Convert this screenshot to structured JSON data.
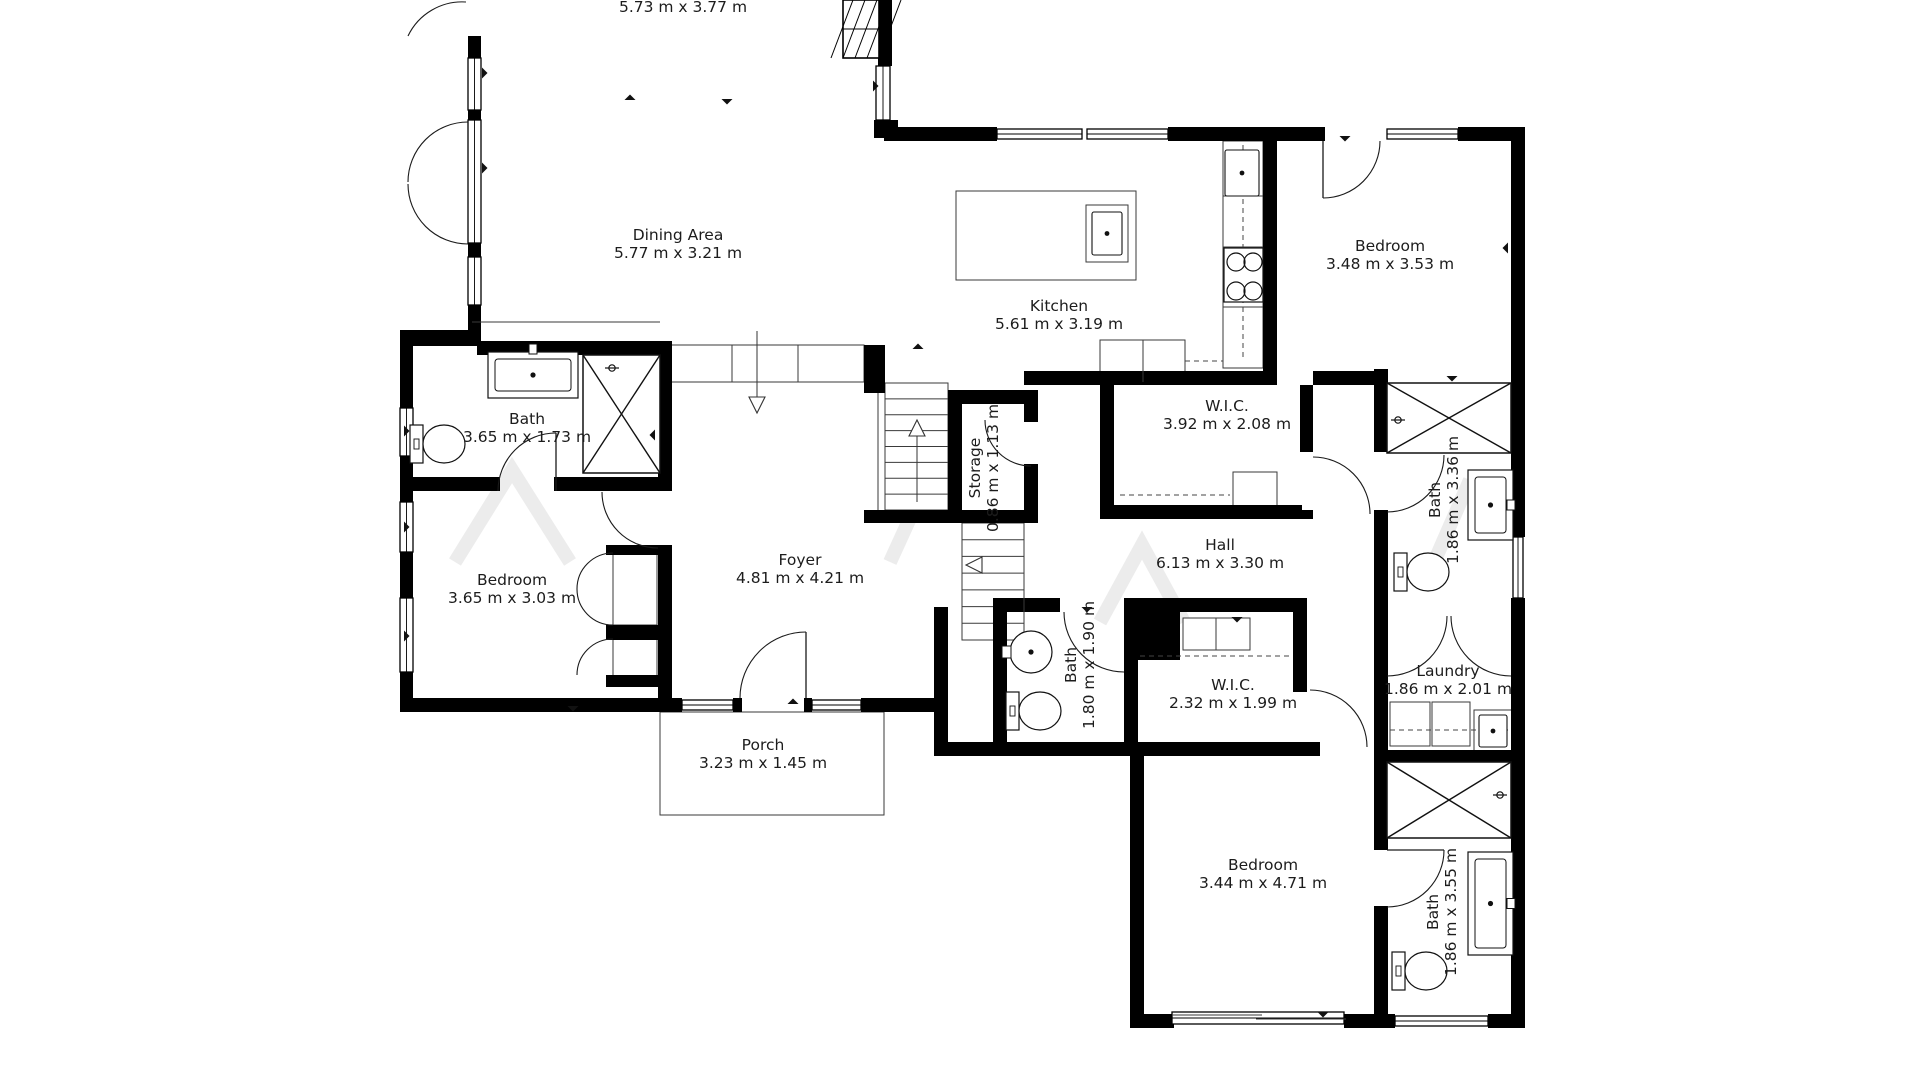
{
  "document": {
    "type": "floor-plan",
    "background": "#ffffff",
    "wall_color": "#000000",
    "line_color": "#222222",
    "label_color": "#1c1c1c"
  },
  "rooms": [
    {
      "id": "living",
      "lines": [
        "5.73 m x 3.77 m"
      ],
      "x": 683,
      "y": 12,
      "rot": 0
    },
    {
      "id": "dining",
      "lines": [
        "Dining Area",
        "5.77 m x 3.21 m"
      ],
      "x": 678,
      "y": 240,
      "rot": 0
    },
    {
      "id": "kitchen",
      "lines": [
        "Kitchen",
        "5.61 m x 3.19 m"
      ],
      "x": 1059,
      "y": 311,
      "rot": 0
    },
    {
      "id": "bedroom-tr",
      "lines": [
        "Bedroom",
        "3.48 m x 3.53 m"
      ],
      "x": 1390,
      "y": 251,
      "rot": 0
    },
    {
      "id": "bath-left",
      "lines": [
        "Bath",
        "3.65 m x 1.73 m"
      ],
      "x": 527,
      "y": 424,
      "rot": 0
    },
    {
      "id": "wic-top",
      "lines": [
        "W.I.C.",
        "3.92 m x 2.08 m"
      ],
      "x": 1227,
      "y": 411,
      "rot": 0
    },
    {
      "id": "hall",
      "lines": [
        "Hall",
        "6.13 m x 3.30 m"
      ],
      "x": 1220,
      "y": 550,
      "rot": 0
    },
    {
      "id": "bath-tr",
      "lines": [
        "Bath",
        "1.86 m x 3.36 m"
      ],
      "x": 1440,
      "y": 500,
      "rot": -90
    },
    {
      "id": "storage",
      "lines": [
        "Storage",
        "0.86 m x 1.13 m"
      ],
      "x": 980,
      "y": 468,
      "rot": -90
    },
    {
      "id": "bath-mid",
      "lines": [
        "Bath",
        "1.80 m x 1.90 m"
      ],
      "x": 1076,
      "y": 665,
      "rot": -90
    },
    {
      "id": "bedroom-l",
      "lines": [
        "Bedroom",
        "3.65 m x 3.03 m"
      ],
      "x": 512,
      "y": 585,
      "rot": 0
    },
    {
      "id": "foyer",
      "lines": [
        "Foyer",
        "4.81 m x 4.21 m"
      ],
      "x": 800,
      "y": 565,
      "rot": 0
    },
    {
      "id": "porch",
      "lines": [
        "Porch",
        "3.23 m x 1.45 m"
      ],
      "x": 763,
      "y": 750,
      "rot": 0
    },
    {
      "id": "wic-mid",
      "lines": [
        "W.I.C.",
        "2.32 m x 1.99 m"
      ],
      "x": 1233,
      "y": 690,
      "rot": 0
    },
    {
      "id": "laundry",
      "lines": [
        "Laundry",
        "1.86 m x 2.01 m"
      ],
      "x": 1448,
      "y": 676,
      "rot": 0
    },
    {
      "id": "bedroom-b",
      "lines": [
        "Bedroom",
        "3.44 m x 4.71 m"
      ],
      "x": 1263,
      "y": 870,
      "rot": 0
    },
    {
      "id": "bath-br",
      "lines": [
        "Bath",
        "1.86 m x 3.55 m"
      ],
      "x": 1438,
      "y": 912,
      "rot": -90
    }
  ],
  "floorplan": {
    "canvas": {
      "w": 1920,
      "h": 1080
    },
    "walls": [
      [
        468,
        36,
        13,
        22
      ],
      [
        468,
        110,
        13,
        12
      ],
      [
        468,
        243,
        13,
        14
      ],
      [
        468,
        305,
        13,
        39
      ],
      [
        400,
        330,
        81,
        16
      ],
      [
        400,
        344,
        13,
        64
      ],
      [
        400,
        456,
        13,
        46
      ],
      [
        400,
        552,
        13,
        46
      ],
      [
        400,
        672,
        13,
        40
      ],
      [
        400,
        698,
        282,
        14
      ],
      [
        733,
        698,
        9,
        14
      ],
      [
        804,
        698,
        8,
        14
      ],
      [
        861,
        698,
        87,
        14
      ],
      [
        934,
        607,
        14,
        149
      ],
      [
        934,
        742,
        386,
        14
      ],
      [
        1130,
        742,
        14,
        286
      ],
      [
        1130,
        1014,
        44,
        14
      ],
      [
        1344,
        1014,
        46,
        14
      ],
      [
        1374,
        1014,
        21,
        14
      ],
      [
        1488,
        1014,
        37,
        14
      ],
      [
        1511,
        127,
        14,
        410
      ],
      [
        1511,
        598,
        14,
        430
      ],
      [
        884,
        127,
        113,
        14
      ],
      [
        1168,
        127,
        157,
        14
      ],
      [
        1458,
        127,
        67,
        14
      ],
      [
        878,
        0,
        14,
        66
      ],
      [
        874,
        120,
        24,
        18
      ],
      [
        477,
        341,
        195,
        14
      ],
      [
        658,
        341,
        14,
        150
      ],
      [
        400,
        477,
        100,
        14
      ],
      [
        554,
        477,
        104,
        14
      ],
      [
        658,
        549,
        14,
        163
      ],
      [
        606,
        545,
        66,
        10
      ],
      [
        606,
        625,
        66,
        15
      ],
      [
        606,
        675,
        66,
        12
      ],
      [
        1263,
        141,
        14,
        244
      ],
      [
        1024,
        371,
        243,
        14
      ],
      [
        1313,
        371,
        61,
        14
      ],
      [
        1100,
        385,
        14,
        134
      ],
      [
        1100,
        505,
        202,
        14
      ],
      [
        1300,
        385,
        13,
        67
      ],
      [
        1300,
        510,
        13,
        9
      ],
      [
        1374,
        369,
        14,
        83
      ],
      [
        1374,
        510,
        14,
        102
      ],
      [
        993,
        598,
        67,
        14
      ],
      [
        1124,
        598,
        183,
        14
      ],
      [
        1374,
        598,
        13,
        14
      ],
      [
        993,
        598,
        14,
        144
      ],
      [
        1124,
        598,
        14,
        158
      ],
      [
        1293,
        612,
        14,
        80
      ],
      [
        1293,
        743,
        14,
        13
      ],
      [
        1374,
        598,
        14,
        252
      ],
      [
        1374,
        906,
        14,
        122
      ],
      [
        1374,
        750,
        151,
        14
      ],
      [
        948,
        390,
        14,
        133
      ],
      [
        948,
        390,
        90,
        14
      ],
      [
        1024,
        404,
        14,
        18
      ],
      [
        1024,
        464,
        14,
        59
      ],
      [
        864,
        510,
        174,
        13
      ],
      [
        864,
        345,
        21,
        48
      ],
      [
        1138,
        612,
        42,
        48
      ]
    ],
    "windows": [
      [
        468,
        58,
        13,
        52
      ],
      [
        468,
        120,
        13,
        123
      ],
      [
        468,
        257,
        13,
        48
      ],
      [
        400,
        408,
        13,
        48
      ],
      [
        400,
        502,
        13,
        50
      ],
      [
        400,
        598,
        13,
        74
      ],
      [
        682,
        700,
        51,
        10
      ],
      [
        812,
        700,
        49,
        10
      ],
      [
        997,
        129,
        85,
        10
      ],
      [
        1087,
        129,
        81,
        10
      ],
      [
        1387,
        129,
        71,
        10
      ],
      [
        876,
        66,
        14,
        54
      ],
      [
        1513,
        537,
        10,
        61
      ],
      [
        1395,
        1016,
        93,
        10
      ],
      [
        1172,
        1012,
        172,
        12
      ]
    ],
    "door_arcs": [
      "M 408,36 A 60 60 0 0 1 466,2",
      "M 408,182 A 60 60 0 0 1 468,122",
      "M 408,184 A 60 60 0 0 0 468,244",
      "M 1380,141 A 57 57 0 0 1 1323,198",
      "M 498,491 A 58 58 0 0 1 556,433",
      "M 602,492 A 56 56 0 0 0 658,548",
      "M 740,698 A 66 66 0 0 1 806,632",
      "M 985,420 A 46 46 0 0 0 1031,466",
      "M 1313,457 A 57 57 0 0 1 1370,514",
      "M 1387,512 A 57 57 0 0 0 1444,455",
      "M 1064,612 A 60 60 0 0 0 1124,672",
      "M 1310,690 A 57 57 0 0 1 1367,747",
      "M 1447,616 A 60 60 0 0 1 1387,676",
      "M 1451,616 A 60 60 0 0 0 1511,676",
      "M 1444,850 A 57 57 0 0 1 1387,907",
      "M 613,553 A 36 36 0 0 0 577,589",
      "M 613,625 A 36 36 0 0 1 577,589",
      "M 613,639 A 36 36 0 0 0 577,675"
    ],
    "door_leaves": [
      [
        556,
        433,
        556,
        491
      ],
      [
        806,
        632,
        806,
        698
      ],
      [
        1323,
        141,
        1323,
        198
      ],
      [
        1387,
        850,
        1444,
        850
      ]
    ],
    "thin_rects": [
      [
        660,
        712,
        224,
        103
      ],
      [
        667,
        345,
        197,
        37
      ],
      [
        1100,
        340,
        85,
        42
      ],
      [
        1223,
        141,
        40,
        227
      ],
      [
        956,
        191,
        180,
        89
      ],
      [
        1086,
        205,
        42,
        57
      ],
      [
        1233,
        472,
        44,
        41
      ],
      [
        1183,
        618,
        67,
        32
      ],
      [
        1390,
        702,
        40,
        44
      ],
      [
        1432,
        702,
        38,
        44
      ],
      [
        1474,
        710,
        38,
        42
      ],
      [
        613,
        553,
        44,
        72
      ],
      [
        613,
        639,
        44,
        38
      ]
    ],
    "thin_lines": [
      [
        472,
        322,
        660,
        322
      ],
      [
        878,
        393,
        878,
        510
      ],
      [
        962,
        523,
        962,
        640
      ],
      [
        1024,
        523,
        1024,
        640
      ],
      [
        732,
        345,
        732,
        382
      ],
      [
        798,
        345,
        798,
        382
      ],
      [
        1143,
        340,
        1143,
        382
      ],
      [
        1223,
        196,
        1263,
        196
      ],
      [
        1223,
        247,
        1263,
        247
      ],
      [
        1223,
        307,
        1263,
        307
      ],
      [
        1172,
        1015,
        1262,
        1015
      ],
      [
        1256,
        1019,
        1346,
        1019
      ],
      [
        1216,
        618,
        1216,
        650
      ]
    ],
    "dashed_lines": [
      [
        1243,
        145,
        1243,
        360
      ],
      [
        1185,
        361,
        1223,
        361
      ],
      [
        1140,
        656,
        1290,
        656
      ],
      [
        1120,
        495,
        1230,
        495
      ],
      [
        1390,
        730,
        1508,
        730
      ]
    ],
    "shower_boxes": [
      [
        583,
        355,
        77,
        118
      ],
      [
        1387,
        383,
        124,
        70
      ],
      [
        1387,
        762,
        124,
        76
      ]
    ],
    "stairs": [
      {
        "x": 885,
        "y": 383,
        "w": 63,
        "h": 127,
        "n": 8
      },
      {
        "x": 962,
        "y": 523,
        "w": 62,
        "h": 117,
        "n": 7
      }
    ],
    "toilets": [
      [
        410,
        423
      ],
      [
        1394,
        551
      ],
      [
        1006,
        690
      ],
      [
        1392,
        950
      ]
    ],
    "vanities": [
      {
        "r": [
          488,
          352,
          90,
          46
        ],
        "f": "top"
      },
      {
        "r": [
          1468,
          470,
          45,
          70
        ],
        "f": "right"
      },
      {
        "r": [
          1468,
          852,
          45,
          103
        ],
        "f": "right"
      }
    ],
    "round_sinks": [
      [
        1031,
        652,
        21
      ]
    ],
    "sink_insets": [
      [
        1225,
        150,
        34,
        46
      ],
      [
        1092,
        212,
        30,
        43
      ],
      [
        1479,
        715,
        28,
        32
      ]
    ],
    "cooktop": {
      "box": [
        1224,
        248,
        39,
        54
      ],
      "burners": [
        [
          1236,
          262
        ],
        [
          1253,
          262
        ],
        [
          1236,
          291
        ],
        [
          1253,
          291
        ]
      ],
      "r": 9
    },
    "shower_heads": [
      [
        612,
        368
      ],
      [
        1398,
        420
      ],
      [
        1500,
        795
      ]
    ],
    "hatch_box": [
      843,
      0,
      36,
      58
    ],
    "arrows": [
      {
        "l": [
          757,
          331,
          757,
          399
        ],
        "h": [
          757,
          405
        ],
        "d": "down"
      },
      {
        "l": [
          917,
          502,
          917,
          434
        ],
        "h": [
          917,
          428
        ],
        "d": "up"
      },
      {
        "h": [
          974,
          565
        ],
        "d": "left"
      }
    ],
    "markers": [
      [
        482,
        73,
        "r"
      ],
      [
        482,
        168,
        "r"
      ],
      [
        404,
        431,
        "r"
      ],
      [
        404,
        527,
        "r"
      ],
      [
        404,
        636,
        "r"
      ],
      [
        655,
        435,
        "l"
      ],
      [
        573,
        706,
        "d"
      ],
      [
        793,
        704,
        "u"
      ],
      [
        918,
        349,
        "u"
      ],
      [
        1452,
        376,
        "d"
      ],
      [
        1508,
        248,
        "l"
      ],
      [
        1323,
        1012,
        "d"
      ],
      [
        1237,
        617,
        "d"
      ],
      [
        1087,
        607,
        "d"
      ],
      [
        1345,
        136,
        "d"
      ],
      [
        630,
        100,
        "u"
      ],
      [
        727,
        99,
        "d"
      ],
      [
        873,
        86,
        "r"
      ]
    ],
    "watermark": [
      "M455,562 L512,470 L570,562",
      "M890,562 L932,470",
      "M1100,622 L1142,545 L1184,622",
      "M1435,560 L1470,480"
    ]
  }
}
